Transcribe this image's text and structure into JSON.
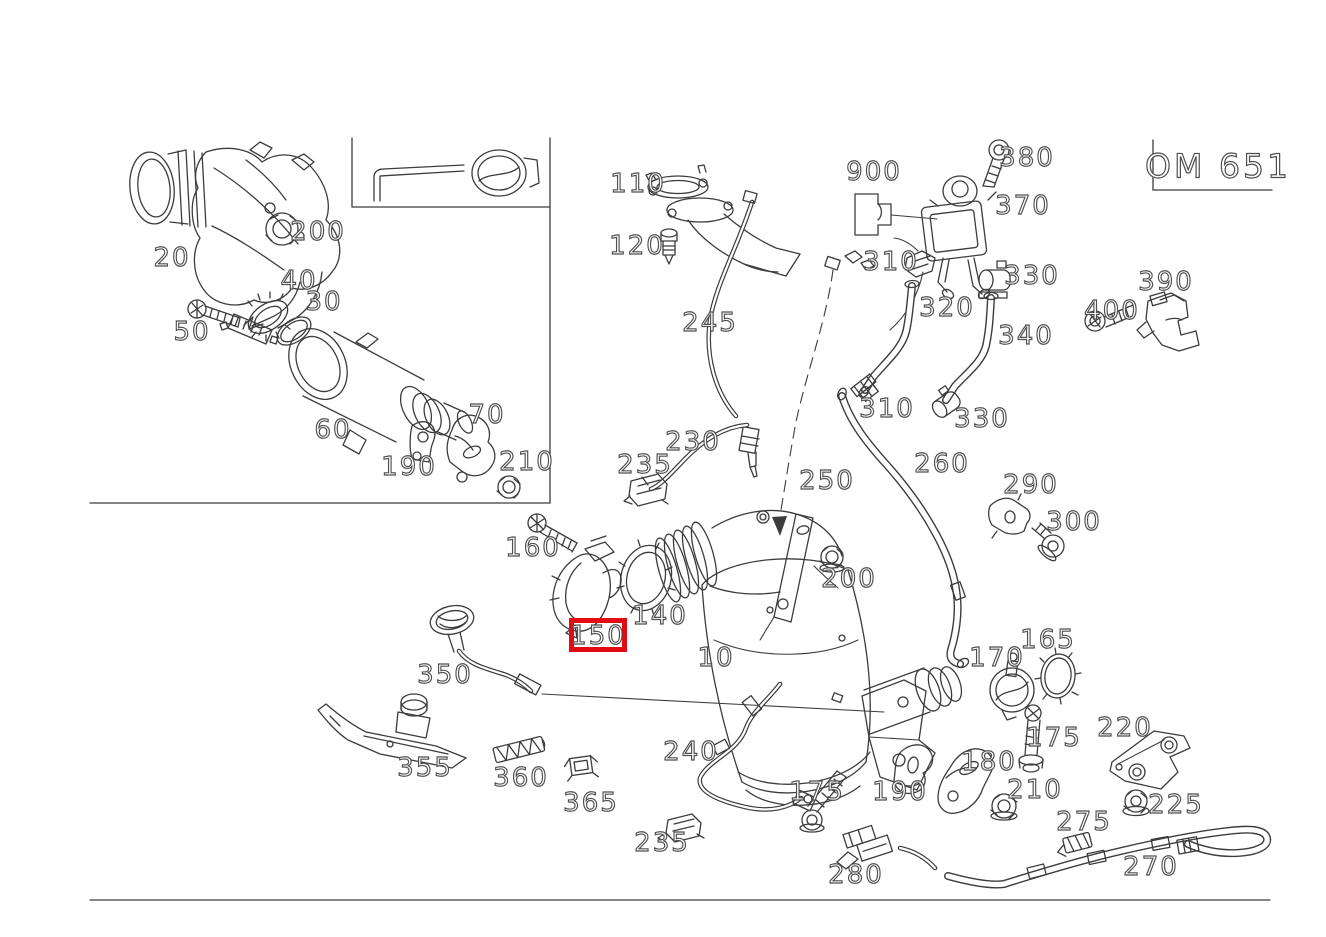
{
  "title_plate": {
    "model": "OM 651"
  },
  "highlighted_part": "150",
  "colors": {
    "highlight_red": "#e30b13",
    "line": "#3c3c3c",
    "label_outline": "#4f4f4f"
  },
  "parts": [
    {
      "num": "20",
      "x": 172,
      "y": 258
    },
    {
      "num": "200",
      "x": 318,
      "y": 232
    },
    {
      "num": "40",
      "x": 299,
      "y": 281
    },
    {
      "num": "30",
      "x": 324,
      "y": 302
    },
    {
      "num": "50",
      "x": 192,
      "y": 332
    },
    {
      "num": "60",
      "x": 333,
      "y": 430
    },
    {
      "num": "70",
      "x": 487,
      "y": 415
    },
    {
      "num": "190",
      "x": 409,
      "y": 467
    },
    {
      "num": "210",
      "x": 527,
      "y": 462
    },
    {
      "num": "110",
      "x": 638,
      "y": 184
    },
    {
      "num": "120",
      "x": 637,
      "y": 246
    },
    {
      "num": "245",
      "x": 710,
      "y": 323
    },
    {
      "num": "900",
      "x": 874,
      "y": 172
    },
    {
      "num": "380",
      "x": 1027,
      "y": 158
    },
    {
      "num": "370",
      "x": 1023,
      "y": 206
    },
    {
      "num": "310",
      "x": 891,
      "y": 262
    },
    {
      "num": "330",
      "x": 1032,
      "y": 276
    },
    {
      "num": "320",
      "x": 947,
      "y": 308
    },
    {
      "num": "340",
      "x": 1026,
      "y": 336
    },
    {
      "num": "390",
      "x": 1166,
      "y": 282
    },
    {
      "num": "400",
      "x": 1112,
      "y": 311
    },
    {
      "num": "310",
      "x": 887,
      "y": 409
    },
    {
      "num": "330",
      "x": 982,
      "y": 419
    },
    {
      "num": "260",
      "x": 942,
      "y": 464
    },
    {
      "num": "290",
      "x": 1031,
      "y": 485
    },
    {
      "num": "300",
      "x": 1074,
      "y": 522
    },
    {
      "num": "230",
      "x": 693,
      "y": 442
    },
    {
      "num": "235",
      "x": 645,
      "y": 465
    },
    {
      "num": "250",
      "x": 827,
      "y": 481
    },
    {
      "num": "160",
      "x": 533,
      "y": 548
    },
    {
      "num": "140",
      "x": 660,
      "y": 616
    },
    {
      "num": "150",
      "x": 598,
      "y": 636,
      "highlighted": true
    },
    {
      "num": "10",
      "x": 716,
      "y": 658
    },
    {
      "num": "200",
      "x": 849,
      "y": 579
    },
    {
      "num": "350",
      "x": 445,
      "y": 675
    },
    {
      "num": "355",
      "x": 425,
      "y": 768
    },
    {
      "num": "360",
      "x": 521,
      "y": 778
    },
    {
      "num": "365",
      "x": 591,
      "y": 803
    },
    {
      "num": "240",
      "x": 691,
      "y": 752
    },
    {
      "num": "235",
      "x": 662,
      "y": 843
    },
    {
      "num": "175",
      "x": 817,
      "y": 792
    },
    {
      "num": "280",
      "x": 856,
      "y": 875
    },
    {
      "num": "190",
      "x": 900,
      "y": 792
    },
    {
      "num": "165",
      "x": 1048,
      "y": 640
    },
    {
      "num": "170",
      "x": 997,
      "y": 658
    },
    {
      "num": "175",
      "x": 1054,
      "y": 738
    },
    {
      "num": "180",
      "x": 989,
      "y": 762
    },
    {
      "num": "210",
      "x": 1035,
      "y": 790
    },
    {
      "num": "220",
      "x": 1125,
      "y": 728
    },
    {
      "num": "225",
      "x": 1176,
      "y": 805
    },
    {
      "num": "275",
      "x": 1084,
      "y": 822
    },
    {
      "num": "270",
      "x": 1151,
      "y": 867
    }
  ]
}
